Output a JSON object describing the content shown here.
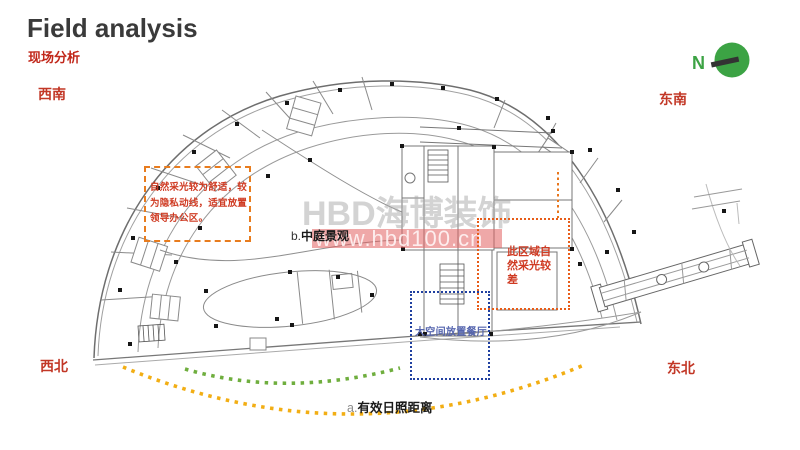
{
  "header": {
    "title": "Field analysis",
    "subtitle": "现场分析"
  },
  "compass": {
    "label": "N"
  },
  "directions": {
    "southwest": "西南",
    "southeast": "东南",
    "northwest": "西北",
    "northeast": "东北"
  },
  "watermark": {
    "brand": "HBD海博装饰",
    "url": "www.hbd100.cn"
  },
  "annotations": {
    "leadership_zone": {
      "text": "自然采光较为舒适，较为隐私动线，适宜放置领导办公区。"
    },
    "atrium_view": {
      "prefix": "b.",
      "label": "中庭景观"
    },
    "poor_daylight": {
      "text": "此区域自然采光较差"
    },
    "dining_space": {
      "text": "大空间放置餐厅"
    },
    "sunlight_distance": {
      "prefix": "a.",
      "label": "有效日照距离"
    }
  },
  "colors": {
    "title_text": "#3a3a3a",
    "accent_red": "#c23726",
    "note_red": "#cf3a22",
    "box_orange": "#e87c1e",
    "box_red_orange": "#e85c18",
    "box_blue": "#2040a0",
    "note_blue": "#5565ae",
    "arc_green": "#6fae3e",
    "arc_yellow": "#f2ae14",
    "compass_green": "#3ca344",
    "highlight_pink": "#e46060",
    "watermark_gray": "#a8a8a8",
    "plan_line": "#8c8c8c"
  }
}
